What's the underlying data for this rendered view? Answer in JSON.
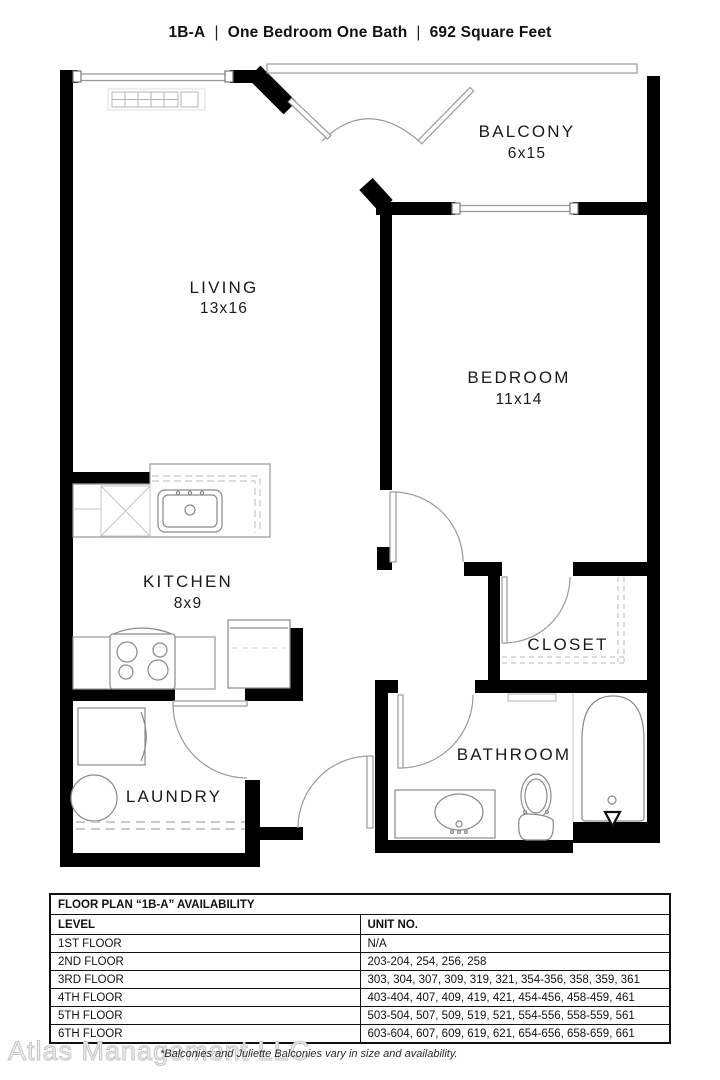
{
  "header": {
    "unit": "1B-A",
    "type": "One Bedroom One Bath",
    "area": "692 Square Feet",
    "separator": "|"
  },
  "rooms": {
    "living": {
      "name": "LIVING",
      "dims": "13x16"
    },
    "kitchen": {
      "name": "KITCHEN",
      "dims": "8x9"
    },
    "laundry": {
      "name": "LAUNDRY"
    },
    "balcony": {
      "name": "BALCONY",
      "dims": "6x15"
    },
    "bedroom": {
      "name": "BEDROOM",
      "dims": "11x14"
    },
    "closet": {
      "name": "CLOSET"
    },
    "bathroom": {
      "name": "BATHROOM"
    }
  },
  "table": {
    "title": "FLOOR PLAN “1B-A” AVAILABILITY",
    "columns": {
      "level": "LEVEL",
      "units": "UNIT NO."
    },
    "rows": [
      {
        "level": "1ST FLOOR",
        "units": "N/A"
      },
      {
        "level": "2ND FLOOR",
        "units": "203-204, 254, 256, 258"
      },
      {
        "level": "3RD FLOOR",
        "units": "303, 304, 307, 309, 319, 321, 354-356, 358, 359, 361"
      },
      {
        "level": "4TH FLOOR",
        "units": "403-404, 407, 409, 419, 421, 454-456, 458-459, 461"
      },
      {
        "level": "5TH FLOOR",
        "units": "503-504, 507, 509, 519, 521, 554-556, 558-559, 561"
      },
      {
        "level": "6TH FLOOR",
        "units": "603-604, 607, 609, 619, 621, 654-656, 658-659, 661"
      }
    ]
  },
  "footer": {
    "watermark": "Atlas Management LLC",
    "note": "*Balconies and Juliette Balconies vary in size and availability."
  },
  "colors": {
    "wall": "#000000",
    "fixture_line": "#8a8a8a",
    "dashed_line": "#c8c8c8",
    "text": "#1a1a1a",
    "watermark": "#e8e8e8"
  }
}
